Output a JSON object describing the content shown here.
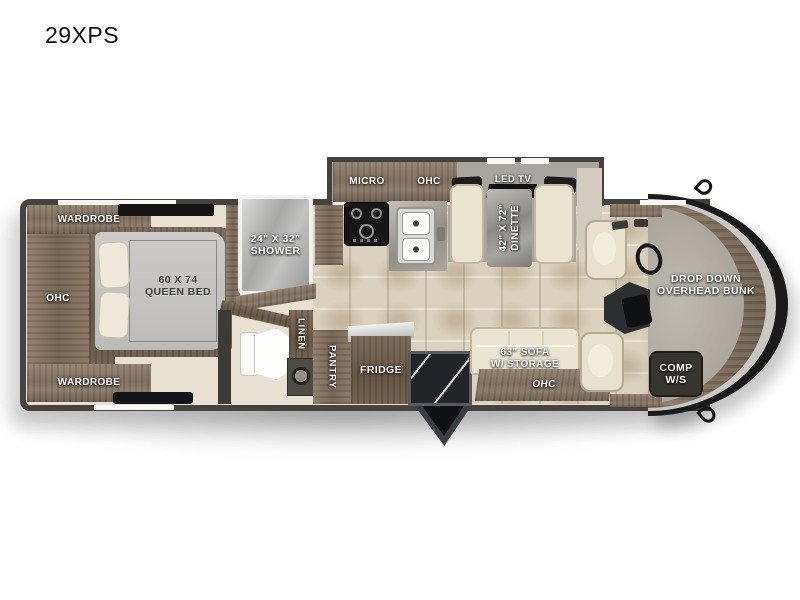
{
  "title": "29XPS",
  "colors": {
    "wall": "#45433f",
    "wood": "#8a7868",
    "cream_furniture": "#ebe4d0",
    "slide_floor": "#a8a49e",
    "floor": "#e8e1d1",
    "tile": "#dbd1bc",
    "cab_gray": "#b5b0a6",
    "accent_black": "#1b1b1b",
    "label_white": "#ffffff"
  },
  "labels": {
    "wardrobe_top": "WARDROBE",
    "bedroom_ohc": "OHC",
    "wardrobe_bottom": "WARDROBE",
    "bed_size": "60 X 74",
    "bed_name": "QUEEN BED",
    "shower_size": "24\" X 32\"",
    "shower_name": "SHOWER",
    "micro": "MICRO",
    "kitchen_ohc": "OHC",
    "led_tv": "LED TV",
    "dinette_size": "42\" X 72\"",
    "dinette_name": "DINETTE",
    "linen": "LINEN",
    "pantry": "PANTRY",
    "fridge": "FRIDGE",
    "sofa_size": "63\" SOFA",
    "sofa_storage": "W/ STORAGE",
    "sofa_ohc": "OHC",
    "bunk_line1": "DROP DOWN",
    "bunk_line2": "OVERHEAD BUNK",
    "comp_line1": "COMP",
    "comp_line2": "W/S"
  }
}
